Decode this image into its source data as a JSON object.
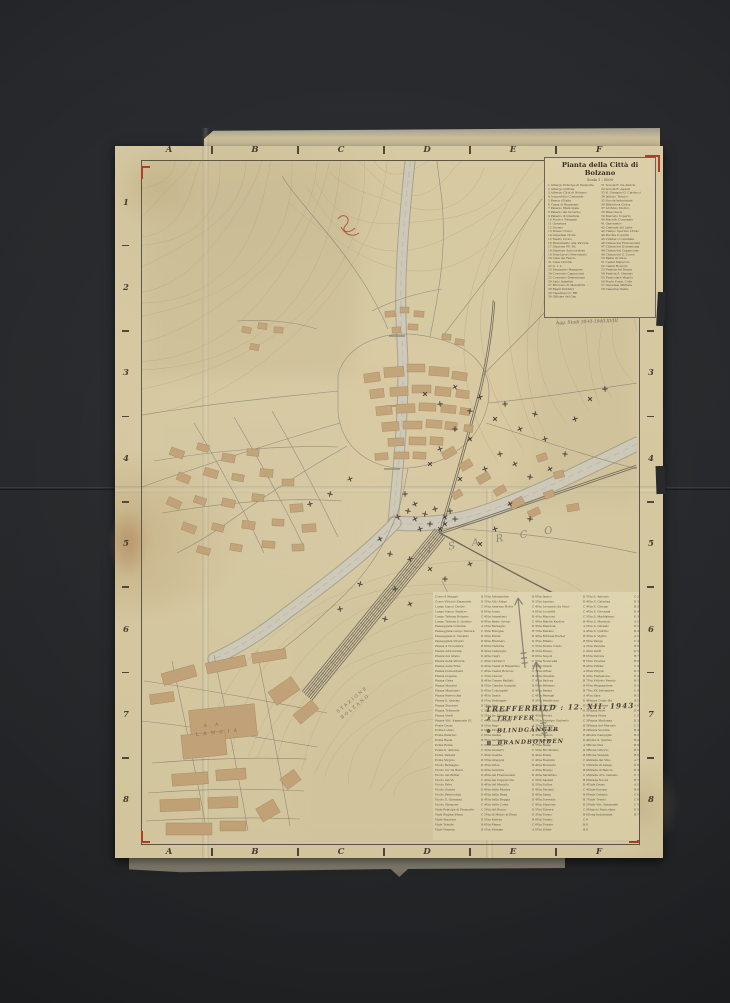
{
  "photo": {
    "background": "#242628",
    "paper": "#d5c8a0",
    "accent_red": "#b23b28",
    "ink": "#4a4336"
  },
  "title_block": {
    "title": "Pianta della Città di Bolzano",
    "scale": "Scala 1 : 5000",
    "note": "Agg. Studi 30-VI-1940-XVIII",
    "legend_left": [
      "1 Albergo Principe di Piemonte",
      "2 Albergo Grifone",
      "3 Albergo Città di Bolzano",
      "4 Acquedotto Comunale",
      "5 Banca d'Italia",
      "6 Cassa di Risparmio",
      "7 Palazzo Municipale",
      "8 Palazzo del Governo",
      "9 Palazzo di Giustizia",
      "10 Poste e Telegrafi",
      "11 Questura",
      "12 Duomo",
      "13 Museo Civico",
      "14 Ospedale Civile",
      "15 Teatro Civico",
      "16 Monumento alla Vittoria",
      "17 Stazione FF. SS.",
      "18 Stazione Autocorriere",
      "19 Dopolavoro Ferroviario",
      "20 Casa del Fascio",
      "21 Casa Littoria",
      "22 G. I. L.",
      "23 Seminario Maggiore",
      "24 Convento Cappuccini",
      "25 Convento Domenicani",
      "26 Asilo Infantile",
      "27 Ricovero di Mendicità",
      "28 Bagni Pubblici",
      "29 Caserma CC. RR.",
      "30 Officine del Gas"
    ],
    "legend_right": [
      "31 Scuola E. De Amicis",
      "32 Scuola R. Agazzi",
      "33 R. Ginnasio G. Carducci",
      "34 Istituto Tecnico",
      "35 Scuola Industriale",
      "36 Biblioteca Civica",
      "37 Archivio Storico",
      "38 Pinacoteca",
      "39 Mercato Coperto",
      "40 Macello Comunale",
      "41 Gasometro",
      "42 Centrale del Latte",
      "43 Campo Sportivo Druso",
      "44 Piscina Coperta",
      "45 Cimitero Comunale",
      "46 Chiesa dei Francescani",
      "47 Chiesa dei Domenicani",
      "48 Chiesa dei Cappuccini",
      "49 Chiesa del S. Cuore",
      "50 Badia di Gries",
      "51 Castel Mareccio",
      "52 Castel Roncolo",
      "53 Funivia del Renon",
      "54 Funivia S. Genesio",
      "55 Funicolare Virgolo",
      "56 Ponte Funiv. Colle",
      "57 Ospedale Militare",
      "58 Caserma Dante"
    ]
  },
  "grid": {
    "columns": [
      "A",
      "B",
      "C",
      "D",
      "E",
      "F"
    ],
    "rows": [
      "1",
      "2",
      "3",
      "4",
      "5",
      "6",
      "7",
      "8"
    ]
  },
  "labels": {
    "river": "ISARCO",
    "factory_line1": "S. A.",
    "factory_line2": "L A N C I A",
    "station_line1": "STAZIONE",
    "station_line2": "BOLZANO"
  },
  "annotation": {
    "title": "TREFFERBILD :  12. XII. 1943",
    "items": [
      {
        "symbol": "✗",
        "text": "TREFFER"
      },
      {
        "symbol": "⊗",
        "text": "BLINDGÄNGER"
      },
      {
        "symbol": "⊠",
        "text": "BRANDBOMBEN"
      }
    ]
  },
  "index": {
    "columns": [
      [
        {
          "n": "Corso 9 Maggio",
          "r": "B 5"
        },
        {
          "n": "Corso Vittorio Emanuele",
          "r": "D 5"
        },
        {
          "n": "Lungo Isarco Destro",
          "r": "C 6"
        },
        {
          "n": "Lungo Isarco Sinistro",
          "r": "D 6"
        },
        {
          "n": "Lungo Talvera Bolzano",
          "r": "C 4"
        },
        {
          "n": "Lungo Talvera S. Quirino",
          "r": "B 4"
        },
        {
          "n": "Passeggiata Guncina",
          "r": "A 2"
        },
        {
          "n": "Passeggiata Lungo Talvera",
          "r": "C 3"
        },
        {
          "n": "Passeggiata S. Osvaldo",
          "r": "D 2"
        },
        {
          "n": "Passeggiata Virgolo",
          "r": "D 6"
        },
        {
          "n": "Piazza 4 Novembre",
          "r": "B 6"
        },
        {
          "n": "Piazza Addolorata",
          "r": "B 4"
        },
        {
          "n": "Piazza del Grano",
          "r": "D 4"
        },
        {
          "n": "Piazza della Vittoria",
          "r": "C 4"
        },
        {
          "n": "Piazza delle Erbe",
          "r": "D 4"
        },
        {
          "n": "Piazza Domenicani",
          "r": "C 4"
        },
        {
          "n": "Piazza Dogana",
          "r": "C 5"
        },
        {
          "n": "Piazza Gries",
          "r": "B 4"
        },
        {
          "n": "Piazza Mazzini",
          "r": "B 5"
        },
        {
          "n": "Piazza Municipio",
          "r": "D 4"
        },
        {
          "n": "Piazza Parrocchia",
          "r": "D 4"
        },
        {
          "n": "Piazza S. Quirino",
          "r": "B 5"
        },
        {
          "n": "Piazza Stazione",
          "r": "D 5"
        },
        {
          "n": "Piazza Tribunale",
          "r": "C 5"
        },
        {
          "n": "Piazza Verdi",
          "r": "D 5"
        },
        {
          "n": "Piazza Vitt. Emanuele III",
          "r": "C 4"
        },
        {
          "n": "Ponte Druso",
          "r": "B 5"
        },
        {
          "n": "Ponte Loreto",
          "r": "D 5"
        },
        {
          "n": "Ponte Palermo",
          "r": "C 6"
        },
        {
          "n": "Ponte Resia",
          "r": "B 3"
        },
        {
          "n": "Ponte Roma",
          "r": "C 5"
        },
        {
          "n": "Ponte S. Antonio",
          "r": "C 3"
        },
        {
          "n": "Ponte Talvera",
          "r": "C 4"
        },
        {
          "n": "Ponte Virgolo",
          "r": "D 5"
        },
        {
          "n": "Vicolo Bersaglio",
          "r": "D 3"
        },
        {
          "n": "Vicolo Ca' de Bezzi",
          "r": "D 4"
        },
        {
          "n": "Vicolo dei Bottai",
          "r": "D 4"
        },
        {
          "n": "Vicolo del Vò",
          "r": "C 4"
        },
        {
          "n": "Vicolo Erbe",
          "r": "D 4"
        },
        {
          "n": "Vicolo Gumer",
          "r": "D 4"
        },
        {
          "n": "Vicolo Parrocchia",
          "r": "D 4"
        },
        {
          "n": "Vicolo S. Giovanni",
          "r": "D 4"
        },
        {
          "n": "Vicolo Stregone",
          "r": "C 4"
        },
        {
          "n": "Viale Principe di Piemonte",
          "r": "C 5"
        },
        {
          "n": "Viale Regina Elena",
          "r": "C 5"
        },
        {
          "n": "Viale Stazione",
          "r": "D 5"
        },
        {
          "n": "Viale Trieste",
          "r": "B 6"
        },
        {
          "n": "Viale Venezia",
          "r": "B 5"
        }
      ],
      [
        {
          "n": "Via Alessandria",
          "r": "B 6"
        },
        {
          "n": "Via Alto Adige",
          "r": "D 5"
        },
        {
          "n": "Via Andreas Hofer",
          "r": "C 4"
        },
        {
          "n": "Via Aosta",
          "r": "A 6"
        },
        {
          "n": "Via Argentieri",
          "r": "D 4"
        },
        {
          "n": "Via Beato Arrigo",
          "r": "C 4"
        },
        {
          "n": "Via Bersaglio",
          "r": "D 3"
        },
        {
          "n": "Via Bologna",
          "r": "B 7"
        },
        {
          "n": "Via Bottai",
          "r": "D 4"
        },
        {
          "n": "Via Brennero",
          "r": "D 3"
        },
        {
          "n": "Via Cadorna",
          "r": "C 5"
        },
        {
          "n": "Via Campiglio",
          "r": "B 2"
        },
        {
          "n": "Via Capri",
          "r": "B 6"
        },
        {
          "n": "Via Carducci",
          "r": "C 5"
        },
        {
          "n": "Via Cassa di Risparmio",
          "r": "C 4"
        },
        {
          "n": "Via Castel Roncolo",
          "r": "C 3"
        },
        {
          "n": "Via Cavour",
          "r": "B 4"
        },
        {
          "n": "Via Cesare Battisti",
          "r": "C 4"
        },
        {
          "n": "Via Claudia Augusta",
          "r": "D 6"
        },
        {
          "n": "Via Conciapelli",
          "r": "D 4"
        },
        {
          "n": "Via Dante",
          "r": "C 4"
        },
        {
          "n": "Via Defregger",
          "r": "B 3"
        },
        {
          "n": "Via Diaz",
          "r": "C 5"
        },
        {
          "n": "Via Dodiciville",
          "r": "D 4"
        },
        {
          "n": "Via Dr. Streiter",
          "r": "D 4"
        },
        {
          "n": "Via Duca d'Aosta",
          "r": "B 5"
        },
        {
          "n": "Via Fago",
          "r": "A 3"
        },
        {
          "n": "Via Firenze",
          "r": "B 6"
        },
        {
          "n": "Via Galilei",
          "r": "D 3"
        },
        {
          "n": "Via Garibaldi",
          "r": "D 5"
        },
        {
          "n": "Via Genova",
          "r": "B 7"
        },
        {
          "n": "Via Gioberti",
          "r": "C 5"
        },
        {
          "n": "Via Goethe",
          "r": "D 4"
        },
        {
          "n": "Via Grappoli",
          "r": "C 4"
        },
        {
          "n": "Via Gries",
          "r": "B 4"
        },
        {
          "n": "Via Guncina",
          "r": "A 3"
        },
        {
          "n": "Via dei Francescani",
          "r": "D 4"
        },
        {
          "n": "Via dei Cappuccini",
          "r": "C 5"
        },
        {
          "n": "Via del Macello",
          "r": "D 5"
        },
        {
          "n": "Via della Mostra",
          "r": "D 4"
        },
        {
          "n": "Via della Rena",
          "r": "D 4"
        },
        {
          "n": "Via della Roggia",
          "r": "D 4"
        },
        {
          "n": "Via delle Corse",
          "r": "C 4"
        },
        {
          "n": "Via del Ronco",
          "r": "E 5"
        },
        {
          "n": "Via di Mezzo ai Piani",
          "r": "E 3"
        },
        {
          "n": "Via Eritrea",
          "r": "B 6"
        },
        {
          "n": "Via Fiume",
          "r": "C 6"
        },
        {
          "n": "Via Firmian",
          "r": "A 6"
        }
      ],
      [
        {
          "n": "Via Isarco",
          "r": "D 5"
        },
        {
          "n": "Via Laurino",
          "r": "D 4"
        },
        {
          "n": "Via Leonardo da Vinci",
          "r": "C 4"
        },
        {
          "n": "Via Locatelli",
          "r": "C 4"
        },
        {
          "n": "Via Marconi",
          "r": "C 5"
        },
        {
          "n": "Via Martin Knoller",
          "r": "B 4"
        },
        {
          "n": "Via Mendola",
          "r": "A 5"
        },
        {
          "n": "Via Merano",
          "r": "A 4"
        },
        {
          "n": "Via Michael Pacher",
          "r": "B 3"
        },
        {
          "n": "Via Milano",
          "r": "B 6"
        },
        {
          "n": "Via Monte Tondo",
          "r": "A 2"
        },
        {
          "n": "Via Museo",
          "r": "C 4"
        },
        {
          "n": "Via Napoli",
          "r": "B 6"
        },
        {
          "n": "Via Novacella",
          "r": "B 5"
        },
        {
          "n": "Via Orazio",
          "r": "B 4"
        },
        {
          "n": "Via Ortles",
          "r": "A 6"
        },
        {
          "n": "Via Osvaldo",
          "r": "D 2"
        },
        {
          "n": "Via Padova",
          "r": "B 7"
        },
        {
          "n": "Via Palermo",
          "r": "B 6"
        },
        {
          "n": "Via Parma",
          "r": "B 7"
        },
        {
          "n": "Via Penegal",
          "r": "A 4"
        },
        {
          "n": "Via Perathoner",
          "r": "D 4"
        },
        {
          "n": "Via Peschiera",
          "r": "B 5"
        },
        {
          "n": "Via Piave",
          "r": "D 5"
        },
        {
          "n": "Via Portici",
          "r": "D 4"
        },
        {
          "n": "Via Principe Umberto",
          "r": "C 3"
        },
        {
          "n": "Via Quirino",
          "r": "B 5"
        },
        {
          "n": "Via Rafenstein",
          "r": "B 2"
        },
        {
          "n": "Via Rencio",
          "r": "E 4"
        },
        {
          "n": "Via Renon",
          "r": "D 4"
        },
        {
          "n": "Via Resia",
          "r": "A 5"
        },
        {
          "n": "Via Rio Molino",
          "r": "D 3"
        },
        {
          "n": "Via Roma",
          "r": "B 5"
        },
        {
          "n": "Via Rosmini",
          "r": "C 4"
        },
        {
          "n": "Via Rovereto",
          "r": "C 5"
        },
        {
          "n": "Via Rovigo",
          "r": "B 6"
        },
        {
          "n": "Via Sarentino",
          "r": "C 2"
        },
        {
          "n": "Via Sassari",
          "r": "B 6"
        },
        {
          "n": "Via Sciliar",
          "r": "D 4"
        },
        {
          "n": "Via Sernesi",
          "r": "C 4"
        },
        {
          "n": "Via Siena",
          "r": "B 6"
        },
        {
          "n": "Via Sorrento",
          "r": "B 7"
        },
        {
          "n": "Via Stazione",
          "r": "D 5"
        },
        {
          "n": "Via Talvera",
          "r": "C 3"
        },
        {
          "n": "Via Torino",
          "r": "B 6"
        },
        {
          "n": "Via Trento",
          "r": "C 6"
        },
        {
          "n": "Via Trieste",
          "r": "B 6"
        },
        {
          "n": "Via Udine",
          "r": "B 6"
        }
      ],
      [
        {
          "n": "Via S. Antonio",
          "r": "C 3"
        },
        {
          "n": "Via S. Caterina",
          "r": "D 3"
        },
        {
          "n": "Via S. Giorgio",
          "r": "B 3"
        },
        {
          "n": "Via S. Giovanni",
          "r": "D 4"
        },
        {
          "n": "Via S. Maddalena",
          "r": "E 3"
        },
        {
          "n": "Via S. Maurizio",
          "r": "A 5"
        },
        {
          "n": "Via S. Osvaldo",
          "r": "D 2"
        },
        {
          "n": "Via S. Quirino",
          "r": "B 4"
        },
        {
          "n": "Via S. Vigilio",
          "r": "A 5"
        },
        {
          "n": "Via Vanga",
          "r": "C 4"
        },
        {
          "n": "Via Venezia",
          "r": "B 6"
        },
        {
          "n": "Via Verdi",
          "r": "D 5"
        },
        {
          "n": "Via Verona",
          "r": "B 7"
        },
        {
          "n": "Via Vicenza",
          "r": "B 6"
        },
        {
          "n": "Via Vintler",
          "r": "C 4"
        },
        {
          "n": "Via Virgolo",
          "r": "D 5"
        },
        {
          "n": "Via Visitazione",
          "r": "E 2"
        },
        {
          "n": "Via Vittorio Veneto",
          "r": "B 5"
        },
        {
          "n": "Via Weggenstein",
          "r": "D 3"
        },
        {
          "n": "Via XX Settembre",
          "r": "C 4"
        },
        {
          "n": "Via Zara",
          "r": "B 5"
        },
        {
          "n": "Piazza Cristo Re",
          "r": "B 5"
        },
        {
          "n": "Piazza d'Armi",
          "r": "A 6"
        },
        {
          "n": "Piazza Erbe",
          "r": "D 4"
        },
        {
          "n": "Piazza Fiera",
          "r": "C 5"
        },
        {
          "n": "Piazza Madonna",
          "r": "D 3"
        },
        {
          "n": "Piazza del Mercato",
          "r": "C 5"
        },
        {
          "n": "Piazza Vecchia",
          "r": "B 4"
        },
        {
          "n": "Ponte Campiglio",
          "r": "B 2"
        },
        {
          "n": "Ponte S. Quirino",
          "r": "B 4"
        },
        {
          "n": "Rione Dux",
          "r": "B 6"
        },
        {
          "n": "Rione Littorio",
          "r": "B 5"
        },
        {
          "n": "Rione Venezia",
          "r": "B 6"
        },
        {
          "n": "Strada del Vino",
          "r": "A 7"
        },
        {
          "n": "Strada di Aslago",
          "r": "D 6"
        },
        {
          "n": "Strada di Rencio",
          "r": "E 4"
        },
        {
          "n": "Strada di S. Genesio",
          "r": "C 1"
        },
        {
          "n": "Strada Nuova",
          "r": "B 7"
        },
        {
          "n": "Viale Druso",
          "r": "A 5"
        },
        {
          "n": "Viale Europa",
          "r": "B 6"
        },
        {
          "n": "Viale Oriente",
          "r": "C 6"
        },
        {
          "n": "Viale Trento",
          "r": "C 6"
        },
        {
          "n": "Viale Vitt. Emanuele",
          "r": "C 5"
        },
        {
          "n": "Virgolo Funicolare",
          "r": "D 5"
        },
        {
          "n": "Zona Industriale",
          "r": "B 7"
        }
      ]
    ]
  },
  "map_marks": {
    "hits": [
      [
        283,
        233
      ],
      [
        298,
        243
      ],
      [
        313,
        226
      ],
      [
        328,
        250
      ],
      [
        338,
        236
      ],
      [
        353,
        258
      ],
      [
        363,
        243
      ],
      [
        378,
        268
      ],
      [
        393,
        253
      ],
      [
        403,
        278
      ],
      [
        328,
        278
      ],
      [
        313,
        268
      ],
      [
        298,
        288
      ],
      [
        288,
        303
      ],
      [
        358,
        293
      ],
      [
        373,
        303
      ],
      [
        388,
        316
      ],
      [
        343,
        308
      ],
      [
        318,
        318
      ],
      [
        263,
        333
      ],
      [
        273,
        343
      ],
      [
        283,
        353
      ],
      [
        293,
        348
      ],
      [
        303,
        356
      ],
      [
        288,
        363
      ],
      [
        278,
        368
      ],
      [
        298,
        368
      ],
      [
        308,
        350
      ],
      [
        273,
        358
      ],
      [
        266,
        350
      ],
      [
        256,
        356
      ],
      [
        303,
        363
      ],
      [
        313,
        358
      ],
      [
        208,
        318
      ],
      [
        188,
        333
      ],
      [
        168,
        343
      ],
      [
        408,
        308
      ],
      [
        423,
        293
      ],
      [
        433,
        258
      ],
      [
        448,
        238
      ],
      [
        463,
        228
      ],
      [
        238,
        378
      ],
      [
        248,
        393
      ],
      [
        268,
        398
      ],
      [
        288,
        408
      ],
      [
        303,
        418
      ],
      [
        328,
        403
      ],
      [
        218,
        423
      ],
      [
        198,
        448
      ],
      [
        368,
        343
      ],
      [
        388,
        358
      ],
      [
        353,
        368
      ],
      [
        338,
        383
      ],
      [
        253,
        428
      ],
      [
        268,
        443
      ],
      [
        243,
        458
      ]
    ],
    "pencil_arrows": [
      [
        525,
        668,
        518,
        598
      ],
      [
        545,
        738,
        536,
        662
      ]
    ]
  }
}
